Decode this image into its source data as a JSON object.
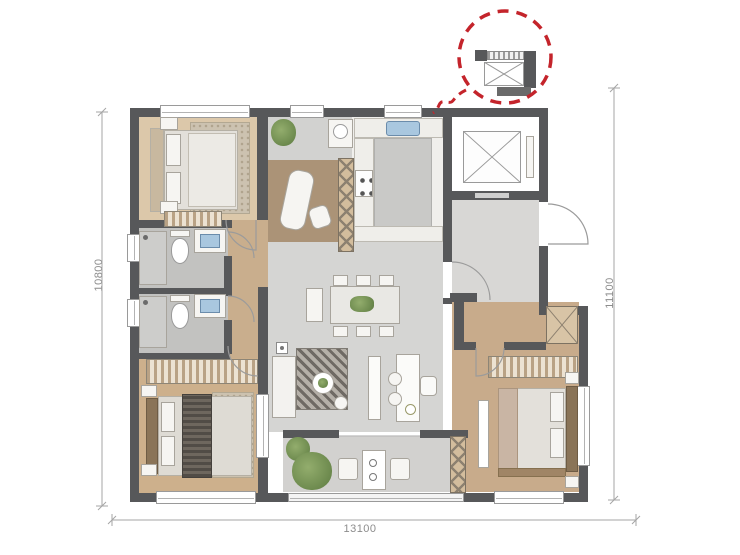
{
  "dimensions": {
    "left": "10800",
    "right": "11100",
    "bottom": "13100"
  },
  "callout": {
    "type": "dashed-circle-highlight",
    "target": "flue-shaft-detail",
    "color": "#c4242b"
  },
  "colors": {
    "wall": "#57585a",
    "wood_light": "#dcc8aa",
    "wood_mid": "#c9ae8d",
    "wood_dark": "#ab9377",
    "tile_gray": "#d5d5d3",
    "marble_gray": "#c2c2c0",
    "sink_blue": "#a9c7df",
    "plant_green": "#7c9b5f",
    "accent_red": "#c4242b",
    "dim_text": "#8c8c8c"
  }
}
